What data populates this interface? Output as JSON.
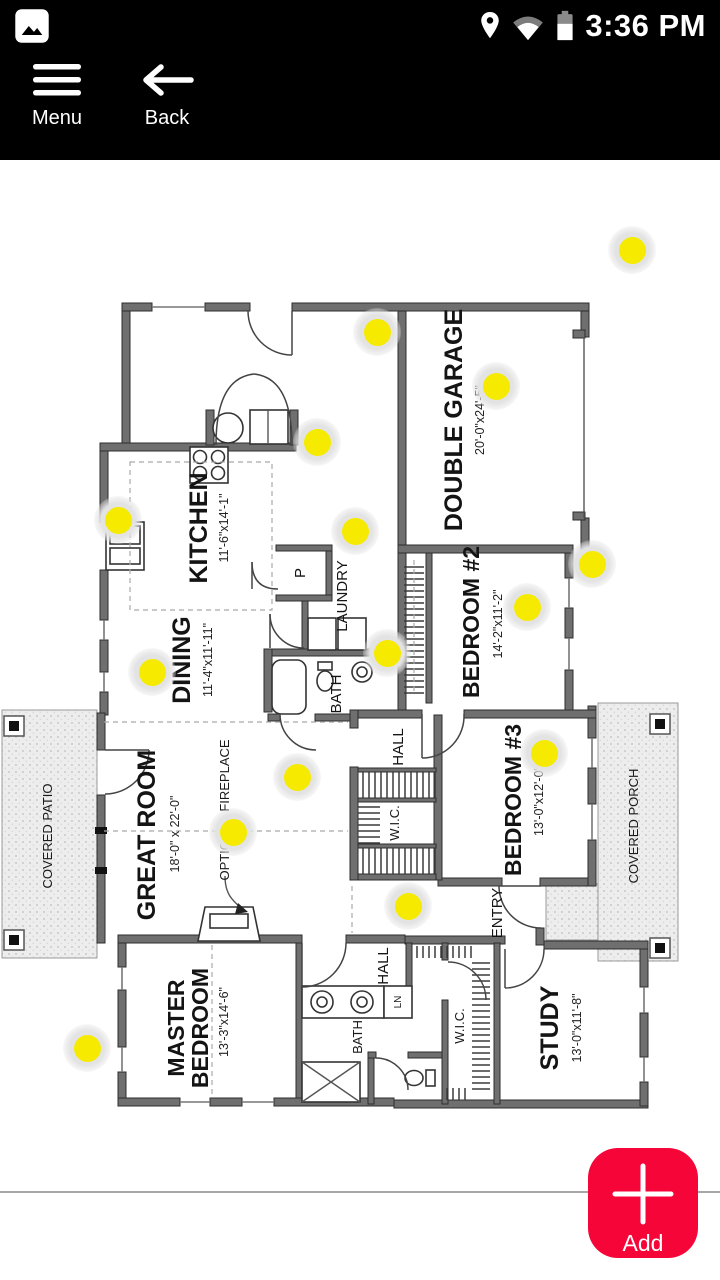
{
  "status_bar": {
    "time": "3:36 PM"
  },
  "toolbar": {
    "menu_label": "Menu",
    "back_label": "Back"
  },
  "fab": {
    "label": "Add",
    "color": "#f60539"
  },
  "colors": {
    "marker": "#f5ea00",
    "marker_halo": "#e3e3e3"
  },
  "floorplan": {
    "rooms": {
      "garage": {
        "name": "DOUBLE GARAGE",
        "dims": "20'-0\"x24'-5\""
      },
      "kitchen": {
        "name": "KITCHEN",
        "dims": "11'-6\"x14'-1\""
      },
      "dining": {
        "name": "DINING",
        "dims": "11'-4\"x11'-11\""
      },
      "laundry": {
        "name": "LAUNDRY"
      },
      "pantry": {
        "name": "P"
      },
      "bath_upper": {
        "name": "BATH"
      },
      "bedroom2": {
        "name": "BEDROOM #2",
        "dims": "14'-2\"x11'-2\""
      },
      "hall_upper": {
        "name": "HALL"
      },
      "wic_upper": {
        "name": "W.I.C."
      },
      "bedroom3": {
        "name": "BEDROOM #3",
        "dims": "13'-0\"x12'-0\""
      },
      "great_room": {
        "name": "GREAT ROOM",
        "dims": "18'-0\" x 22'-0\""
      },
      "fireplace": {
        "name": "OPTIONAL FIREPLACE"
      },
      "patio": {
        "name": "COVERED PATIO"
      },
      "porch": {
        "name": "COVERED PORCH"
      },
      "entry": {
        "name": "ENTRY"
      },
      "master": {
        "line1": "MASTER",
        "line2": "BEDROOM",
        "dims": "13'-3\"x14'-6\""
      },
      "hall_lower": {
        "name": "HALL"
      },
      "linen": {
        "name": "LN"
      },
      "bath_lower": {
        "name": "BATH"
      },
      "wic_lower": {
        "name": "W.I.C."
      },
      "study": {
        "name": "STUDY",
        "dims": "13'-0\"x11'-8\""
      }
    }
  },
  "markers": [
    {
      "x": 632,
      "y": 250
    },
    {
      "x": 377,
      "y": 332
    },
    {
      "x": 496,
      "y": 386
    },
    {
      "x": 317,
      "y": 442
    },
    {
      "x": 118,
      "y": 520
    },
    {
      "x": 355,
      "y": 531
    },
    {
      "x": 592,
      "y": 564
    },
    {
      "x": 527,
      "y": 607
    },
    {
      "x": 387,
      "y": 653
    },
    {
      "x": 152,
      "y": 672
    },
    {
      "x": 544,
      "y": 753
    },
    {
      "x": 297,
      "y": 777
    },
    {
      "x": 233,
      "y": 832
    },
    {
      "x": 408,
      "y": 906
    },
    {
      "x": 87,
      "y": 1048
    }
  ]
}
